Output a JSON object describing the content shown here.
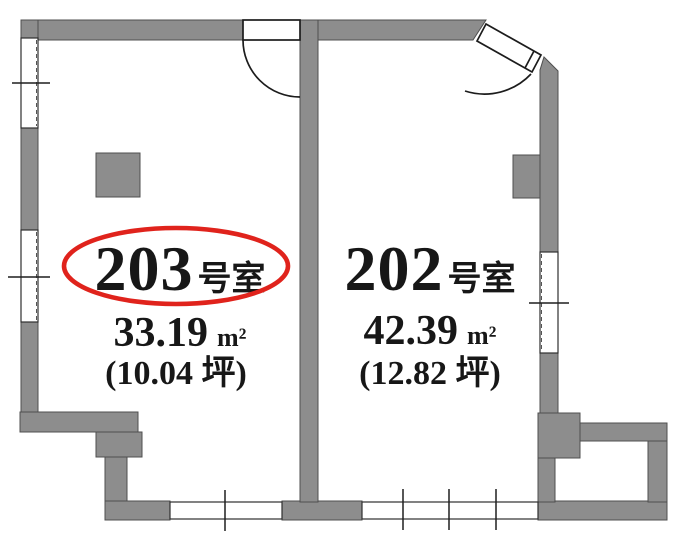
{
  "rooms": [
    {
      "number": "203",
      "suffix": "号室",
      "area": "33.19",
      "area_unit": "m²",
      "tsubo": "(10.04 坪)",
      "highlighted": true
    },
    {
      "number": "202",
      "suffix": "号室",
      "area": "42.39",
      "area_unit": "m²",
      "tsubo": "(12.82 坪)",
      "highlighted": false
    }
  ],
  "annotations": {
    "highlight_ellipse_room": "203"
  },
  "colors": {
    "wall": "#8d8d8d",
    "highlight": "#e0231c",
    "ink": "#171717",
    "background": "#ffffff"
  }
}
